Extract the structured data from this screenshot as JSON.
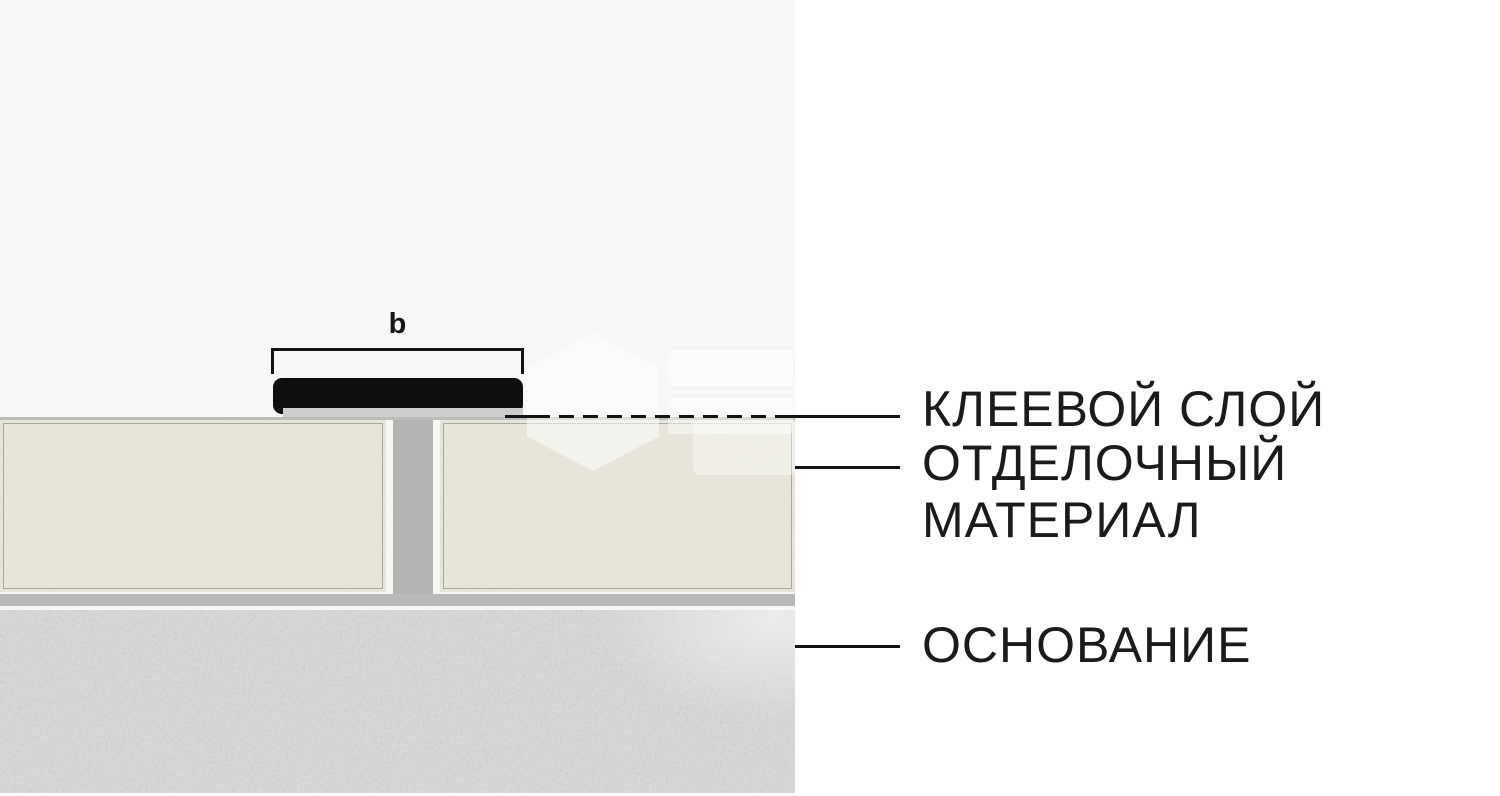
{
  "page": {
    "background_left": "#f7f7f6",
    "background_right": "#ffffff"
  },
  "dimension": {
    "label": "b"
  },
  "callouts": {
    "adhesive_layer": "КЛЕЕВОЙ СЛОЙ",
    "finishing_material_line1": "ОТДЕЛОЧНЫЙ",
    "finishing_material_line2": "МАТЕРИАЛ",
    "substrate": "ОСНОВАНИЕ"
  },
  "materials": {
    "profile_color": "#0e0e0e",
    "adhesive_strip_color": "#cdcdcb",
    "joint_color": "#b4b4b2",
    "panel_color": "#eae8dc",
    "panel_border_color": "#a8a8a0",
    "adhesive_bed_color": "#b9b9b7",
    "substrate_color": "#d8d8d8",
    "leader_line_color": "#141414",
    "text_color": "#1b1b1b"
  },
  "watermark": {
    "present": true
  }
}
